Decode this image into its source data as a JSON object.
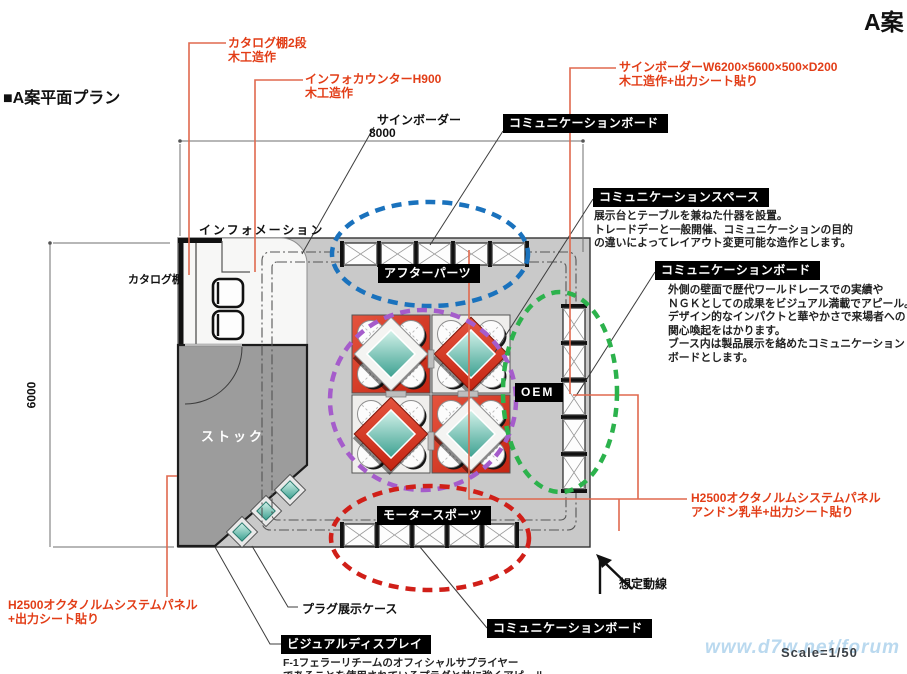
{
  "title": "A案",
  "section_title": "■A案平面プラン",
  "scale_label": "Scale=1/50",
  "watermark": "www.d7w.net/forum",
  "dimensions": {
    "width": "8000",
    "depth": "6000"
  },
  "annotations_red": {
    "catalog_shelf": {
      "line1": "カタログ棚2段",
      "line2": "木工造作"
    },
    "info_counter": {
      "line1": "インフォカウンターH900",
      "line2": "木工造作"
    },
    "sign_border": {
      "line1": "サインボーダーW6200×5600×500×D200",
      "line2": "木工造作+出力シート貼り"
    },
    "octanorm_right": {
      "line1": "H2500オクタノルムシステムパネル",
      "line2": "アンドン乳半+出力シート貼り"
    },
    "octanorm_left": {
      "line1": "H2500オクタノルムシステムパネル",
      "line2": "+出力シート貼り"
    }
  },
  "plan_labels": {
    "sign_border": "サインボーダー",
    "information": "インフォメーション",
    "catalog_shelf": "カタログ棚",
    "stock": "ストック",
    "plug_case": "プラグ展示ケース",
    "flow_line": "想定動線",
    "oem": "OEM"
  },
  "zones": {
    "comm_board_top": {
      "title": "コミュニケーションボード"
    },
    "comm_space": {
      "title": "コミュニケーションスペース",
      "desc": [
        "展示台とテーブルを兼ねた什器を設置。",
        "トレードデーと一般開催、コミュニケーションの目的",
        "の違いによってレイアウト変更可能な造作とします。"
      ]
    },
    "comm_board_right": {
      "title": "コミュニケーションボード",
      "desc": [
        "外側の壁面で歴代ワールドレースでの実績や",
        "ＮＧＫとしての成果をビジュアル満載でアピール。",
        "デザイン的なインパクトと華やかさで来場者への",
        "関心喚起をはかります。",
        "ブース内は製品展示を絡めたコミュニケーション",
        "ボードとします。"
      ]
    },
    "after_parts": {
      "title": "アフターパーツ"
    },
    "motor_sports": {
      "title": "モータースポーツ"
    },
    "comm_board_bottom": {
      "title": "コミュニケーションボード"
    },
    "visual_display": {
      "title": "ビジュアルディスプレイ",
      "desc": [
        "F-1フェラーリチームのオフィシャルサプライヤー",
        "であることを使用されているプラグと共に強くアピール。"
      ]
    }
  },
  "colors": {
    "annotation_red": "#e23d17",
    "leader_red": "#e0694e",
    "ellipse_blue": "#1a72bd",
    "ellipse_purple": "#a55ccb",
    "ellipse_green": "#2cb24c",
    "ellipse_red": "#d01f18",
    "table_red": "#d63c27",
    "floor_gray": "#c9c9c9",
    "stock_gray": "#9c9c9c",
    "case_teal": "#5cc3b4"
  }
}
